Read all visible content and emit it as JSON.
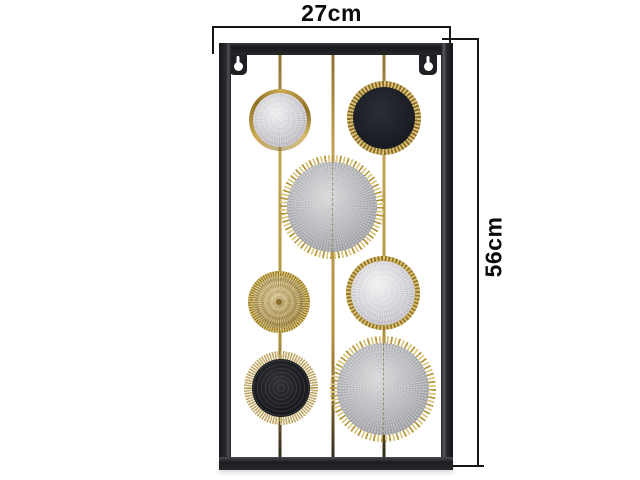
{
  "page": {
    "background": "#ffffff"
  },
  "annotations": {
    "width_label": "27cm",
    "height_label": "56cm",
    "line_color": "#161616"
  },
  "artwork": {
    "description": "black rectangular metal wall decor panel with gold rods and round medallions",
    "frame_color": "#222428",
    "gold_color": "#b6954a",
    "mesh_grey": "#b3b4b8",
    "pale_grey": "#d8d6db",
    "black": "#1c1e24",
    "hanger_xs": [
      229,
      419
    ],
    "hanger_y": 52,
    "rod_xs": [
      280,
      333,
      384
    ],
    "circles": [
      {
        "name": "pale-doily-small",
        "style": "pale-ring",
        "x": 280,
        "y": 120,
        "r": 31
      },
      {
        "name": "black-fluted",
        "style": "black-fluted",
        "x": 384,
        "y": 118,
        "r": 37
      },
      {
        "name": "grey-mesh-upper",
        "style": "mesh-lace",
        "x": 332,
        "y": 207,
        "r": 52
      },
      {
        "name": "gold-pleated",
        "style": "gold-pleat",
        "x": 279,
        "y": 302,
        "r": 31
      },
      {
        "name": "pale-fluted",
        "style": "pale-fluted",
        "x": 383,
        "y": 293,
        "r": 37
      },
      {
        "name": "black-fringe",
        "style": "black-fringe",
        "x": 281,
        "y": 388,
        "r": 37
      },
      {
        "name": "grey-mesh-lower",
        "style": "mesh-lace",
        "x": 383,
        "y": 389,
        "r": 53
      }
    ]
  }
}
